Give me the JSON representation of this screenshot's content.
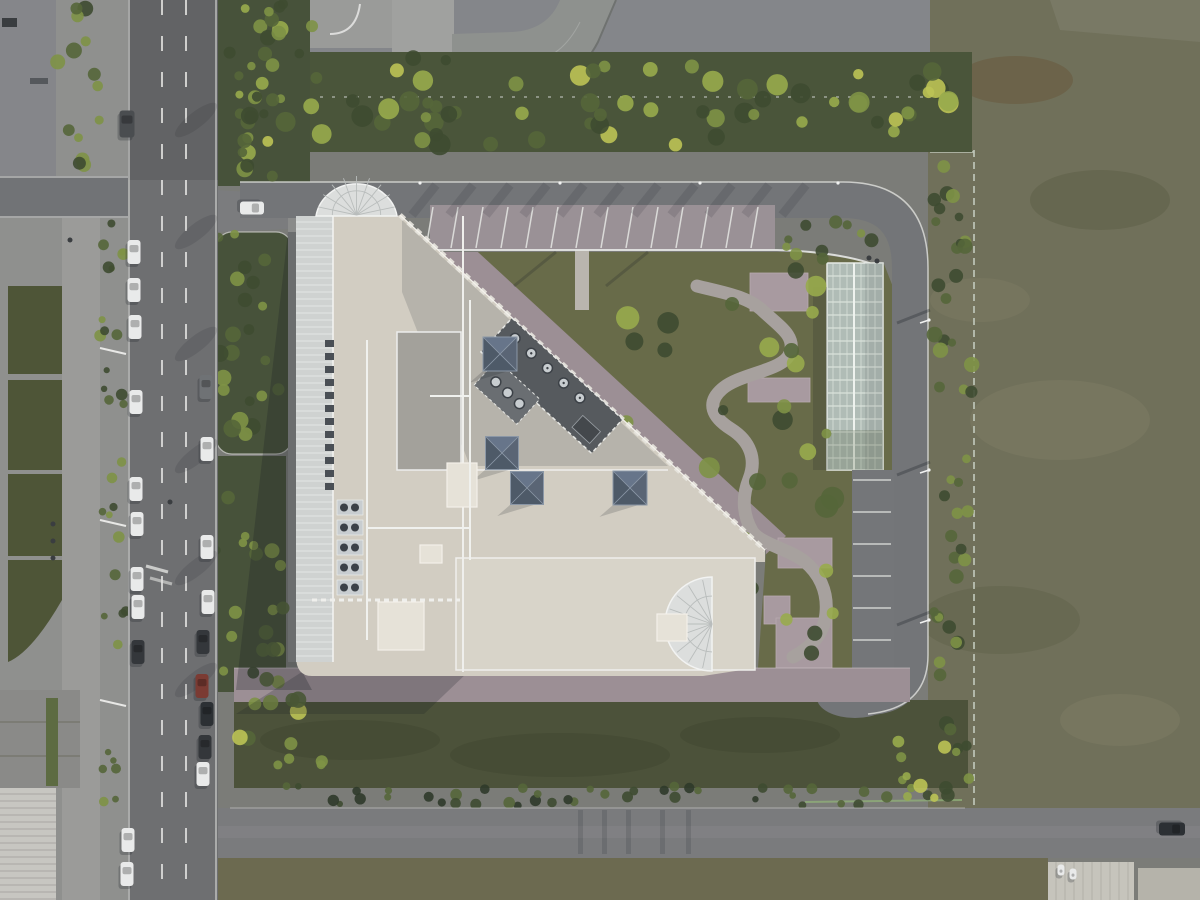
{
  "scene": {
    "title": "Aerial top-down drone photograph of an institutional building compound",
    "description": "Top-down aerial view: city road with parked cars on the left, a walled compound in the center containing a large white-roofed building with pyramid skylights, rounded glazed ends, rooftop HVAC, a landscaped garden with a winding path, a long glass greenhouse, perimeter ring road with parking, lawns and tree belts; olive grass fields to the right and bottom.",
    "type": "aerial-photograph",
    "contains_text": false
  },
  "palette": {
    "roadDark": "#616366",
    "road": "#707274",
    "roadLight": "#7d7e80",
    "bottomRoad": "#7a7b7d",
    "sidewalk": "#9b9b99",
    "plazaLeft": "#8f908e",
    "plazaLeftDark": "#85868a",
    "curb": "#e6e7e4",
    "laneLine": "#e2e2e0",
    "treeDark": "#3e4b31",
    "tree": "#55663a",
    "treeBright": "#7e9246",
    "treeYellow": "#bdc355",
    "treeLime": "#98ab4c",
    "stripBase": "#47523a",
    "soil": "#6f6852",
    "field": "#70705a",
    "fieldLight": "#7b7a62",
    "fieldDark": "#62644c",
    "fieldBrown": "#6b6046",
    "lawn": "#4c523a",
    "hedge": "#2f3a2a",
    "fence": "#c3cbbd",
    "fenceGreen": "#8fae78",
    "brick": "#9c8f95",
    "brickLight": "#a89aa0",
    "deck": "#d2cdc2",
    "deckLight": "#e6e2d8",
    "deckGray": "#b2b0a9",
    "panelGray": "#a3a19b",
    "glass": "#dcdedd",
    "mullion": "#f2f3f2",
    "arcade": "#cfd2d1",
    "pyramid": "#4e5a68",
    "pyramidLight": "#67758a",
    "pyramidGrid": "#8b97a6",
    "court": "#565a5e",
    "courtDark": "#44484c",
    "fan": "#c8cdd0",
    "fanDark": "#3c4147",
    "greenhouse": "#b0bcb6",
    "greenhouseLine": "#d9e1db",
    "greenhouseRidge": "#eef2ee",
    "white": "#efefec",
    "carWhite": "#e9eaea",
    "carDark": "#34373b",
    "carDark2": "#2c3034",
    "carRed": "#7b3b33",
    "carGray": "#6f7275",
    "truck": "#4a4d50",
    "canopy": "#8e918e",
    "bldgRoofA": "#c6c4bc",
    "bldgRoofB": "#b5b3aa",
    "stripeRoof": "#c7c6c1",
    "stripeLine": "#a8a7a2",
    "greenWall": "#5d6b42",
    "shadow": "#1c2026"
  },
  "objects": {
    "cars": [
      [
        134,
        252,
        0,
        "carWhite",
        13,
        24
      ],
      [
        134,
        290,
        0,
        "carWhite",
        13,
        24
      ],
      [
        135,
        327,
        0,
        "carWhite",
        13,
        24
      ],
      [
        136,
        402,
        0,
        "carWhite",
        13,
        24
      ],
      [
        136,
        489,
        0,
        "carWhite",
        13,
        24
      ],
      [
        137,
        524,
        0,
        "carWhite",
        13,
        24
      ],
      [
        137,
        579,
        0,
        "carWhite",
        13,
        24
      ],
      [
        138,
        607,
        0,
        "carWhite",
        13,
        24
      ],
      [
        138,
        652,
        0,
        "carDark",
        13,
        24
      ],
      [
        128,
        840,
        0,
        "carWhite",
        13,
        24
      ],
      [
        127,
        874,
        0,
        "carWhite",
        13,
        24
      ],
      [
        127,
        124,
        0,
        "truck",
        15,
        27
      ],
      [
        206,
        387,
        0,
        "carGray",
        13,
        24
      ],
      [
        207,
        449,
        0,
        "carWhite",
        13,
        24
      ],
      [
        207,
        547,
        0,
        "carWhite",
        13,
        24
      ],
      [
        208,
        602,
        0,
        "carWhite",
        13,
        24
      ],
      [
        203,
        642,
        0,
        "carDark",
        13,
        24
      ],
      [
        202,
        686,
        0,
        "carRed",
        13,
        24
      ],
      [
        207,
        714,
        0,
        "carDark2",
        13,
        24
      ],
      [
        205,
        747,
        0,
        "carDark",
        13,
        24
      ],
      [
        203,
        774,
        0,
        "carWhite",
        13,
        24
      ],
      [
        252,
        208,
        90,
        "carWhite",
        13,
        24
      ],
      [
        1172,
        829,
        90,
        "carDark2",
        13,
        26
      ],
      [
        1061,
        870,
        0,
        "carWhite",
        7,
        11
      ],
      [
        1073,
        874,
        0,
        "carWhite",
        7,
        11
      ]
    ],
    "motorcycles": [
      [
        70,
        240
      ],
      [
        170,
        502
      ],
      [
        53,
        524
      ],
      [
        53,
        541
      ],
      [
        53,
        558
      ],
      [
        869,
        258
      ],
      [
        877,
        261
      ]
    ],
    "pyramid_skylights": [
      [
        500,
        354,
        34
      ],
      [
        502,
        453,
        33
      ],
      [
        527,
        488,
        33
      ],
      [
        630,
        488,
        34
      ]
    ],
    "hvac_fans_local": [
      [
        16,
        13
      ],
      [
        38,
        13
      ],
      [
        60,
        13
      ],
      [
        82,
        13
      ],
      [
        104,
        13
      ]
    ],
    "hvac_boxes_local": [
      [
        8,
        26,
        22,
        14
      ],
      [
        118,
        24,
        24,
        16
      ]
    ],
    "condensers": {
      "x": 337,
      "y0": 500,
      "step": 20,
      "count": 5,
      "w": 26,
      "h": 15
    },
    "vents": {
      "x": 325,
      "y0": 340,
      "step": 13,
      "count": 12,
      "w": 9,
      "h": 7
    },
    "pipes": [
      "M367,340 V640",
      "M367,528 H470",
      "M470,300 V560",
      "M430,396 H470"
    ],
    "garden_path_d": "M697,286 C720,292 748,296 763,311 C780,327 796,336 790,353 C784,371 740,373 722,389 C706,403 712,417 731,429 C750,441 757,459 749,479 C741,499 744,517 752,531 C760,544 789,549 804,561 C819,573 828,591 826,613 C824,635 811,647 793,657",
    "greenhouse": {
      "x": 827,
      "y": 263,
      "w": 56,
      "h": 207,
      "bay_step": 13,
      "mullions_x": [
        833,
        840,
        847,
        861,
        868,
        875
      ],
      "ridge_x": 854
    },
    "parking_north": {
      "x0": 433,
      "x1": 772,
      "step": 25,
      "y_top": 207,
      "y_bot": 248,
      "skew": -7
    },
    "parking_east": {
      "x0": 853,
      "x1": 891,
      "y0": 480,
      "step": 32,
      "count": 6
    },
    "lane_dashes": {
      "xs": [
        162,
        186
      ],
      "dash": 15,
      "gap": 21,
      "y0": 0,
      "y1": 900
    },
    "plaza_pads": [
      [
        750,
        273,
        58,
        38
      ],
      [
        748,
        378,
        62,
        24
      ],
      [
        778,
        538,
        54,
        30
      ],
      [
        764,
        596,
        26,
        28
      ],
      [
        776,
        618,
        56,
        52
      ]
    ],
    "walkway_north": [
      575,
      250,
      14,
      60
    ],
    "roof_boxes": [
      [
        447,
        463,
        30,
        44
      ],
      [
        378,
        602,
        46,
        48
      ],
      [
        657,
        614,
        30,
        27
      ],
      [
        420,
        545,
        22,
        18
      ]
    ],
    "wall_streaks_x": [
      578,
      602,
      626,
      660,
      686
    ],
    "lamp_dots_north": [
      420,
      560,
      700,
      838
    ],
    "lamp_arms_east": [
      [
        929,
        320
      ],
      [
        929,
        470
      ],
      [
        929,
        620
      ]
    ],
    "road_shadow_streaks": {
      "x0": 436,
      "x1": 840,
      "step": 37,
      "dx": -24,
      "y0": 185,
      "y1": 215,
      "w": 9,
      "op": 0.13
    },
    "east_road_streaks": [
      [
        930,
        310
      ],
      [
        930,
        462
      ],
      [
        930,
        612
      ]
    ],
    "garden_lamp_streaks": [
      [
        556,
        252
      ],
      [
        648,
        252
      ]
    ],
    "tree_zones": [
      {
        "x0": 216,
        "y0": 4,
        "x1": 292,
        "y1": 180,
        "n": 24,
        "rmin": 4,
        "rmax": 9,
        "seed": 11,
        "colors": [
          "tree",
          "treeDark",
          "treeBright",
          "treeLime"
        ]
      },
      {
        "x0": 216,
        "y0": 232,
        "x1": 292,
        "y1": 450,
        "n": 22,
        "rmin": 4,
        "rmax": 9,
        "seed": 21,
        "colors": [
          "tree",
          "treeDark",
          "treeBright"
        ]
      },
      {
        "x0": 216,
        "y0": 456,
        "x1": 286,
        "y1": 688,
        "n": 20,
        "rmin": 4,
        "rmax": 8,
        "seed": 31,
        "colors": [
          "tree",
          "treeDark",
          "treeBright"
        ]
      },
      {
        "x0": 244,
        "y0": 58,
        "x1": 966,
        "y1": 148,
        "n": 70,
        "rmin": 5,
        "rmax": 11,
        "seed": 41,
        "colors": [
          "treeDark",
          "tree",
          "treeBright",
          "treeYellow",
          "treeLime"
        ]
      },
      {
        "x0": 934,
        "y0": 162,
        "x1": 972,
        "y1": 802,
        "n": 48,
        "rmin": 4,
        "rmax": 8,
        "seed": 51,
        "colors": [
          "treeDark",
          "tree",
          "treeBright"
        ]
      },
      {
        "x0": 625,
        "y0": 262,
        "x1": 840,
        "y1": 658,
        "n": 40,
        "rmin": 5,
        "rmax": 12,
        "seed": 61,
        "colors": [
          "tree",
          "treeDark",
          "treeBright",
          "treeLime"
        ]
      },
      {
        "x0": 236,
        "y0": 786,
        "x1": 960,
        "y1": 806,
        "n": 42,
        "rmin": 3,
        "rmax": 6,
        "seed": 71,
        "colors": [
          "hedge",
          "treeDark",
          "tree"
        ]
      },
      {
        "x0": 100,
        "y0": 222,
        "x1": 128,
        "y1": 804,
        "n": 32,
        "rmin": 3,
        "rmax": 6,
        "seed": 81,
        "colors": [
          "treeDark",
          "tree",
          "treeBright"
        ]
      },
      {
        "x0": 56,
        "y0": 4,
        "x1": 100,
        "y1": 166,
        "n": 14,
        "rmin": 4,
        "rmax": 8,
        "seed": 91,
        "colors": [
          "tree",
          "treeDark",
          "treeBright"
        ]
      },
      {
        "x0": 782,
        "y0": 222,
        "x1": 886,
        "y1": 264,
        "n": 10,
        "rmin": 4,
        "rmax": 8,
        "seed": 101,
        "colors": [
          "tree",
          "treeBright",
          "treeDark"
        ]
      },
      {
        "x0": 232,
        "y0": 694,
        "x1": 322,
        "y1": 782,
        "n": 12,
        "rmin": 4,
        "rmax": 9,
        "seed": 111,
        "colors": [
          "tree",
          "treeBright",
          "treeYellow"
        ]
      },
      {
        "x0": 262,
        "y0": 4,
        "x1": 338,
        "y1": 56,
        "n": 8,
        "rmin": 4,
        "rmax": 8,
        "seed": 121,
        "colors": [
          "tree",
          "treeDark",
          "treeBright"
        ]
      },
      {
        "x0": 895,
        "y0": 715,
        "x1": 960,
        "y1": 798,
        "n": 10,
        "rmin": 4,
        "rmax": 8,
        "seed": 131,
        "colors": [
          "treeLime",
          "treeBright",
          "treeYellow"
        ]
      }
    ],
    "field_patches": [
      [
        1015,
        80,
        58,
        24,
        "fieldBrown",
        0.8
      ],
      [
        1100,
        200,
        70,
        30,
        "fieldDark",
        0.7
      ],
      [
        1060,
        420,
        90,
        40,
        "fieldLight",
        0.6
      ],
      [
        1000,
        620,
        80,
        34,
        "fieldDark",
        0.55
      ],
      [
        1120,
        720,
        60,
        26,
        "fieldLight",
        0.6
      ],
      [
        980,
        300,
        50,
        22,
        "fieldLight",
        0.5
      ]
    ],
    "lawn_patches": [
      [
        350,
        740,
        90,
        20
      ],
      [
        560,
        755,
        110,
        22
      ],
      [
        760,
        735,
        80,
        18
      ]
    ]
  }
}
